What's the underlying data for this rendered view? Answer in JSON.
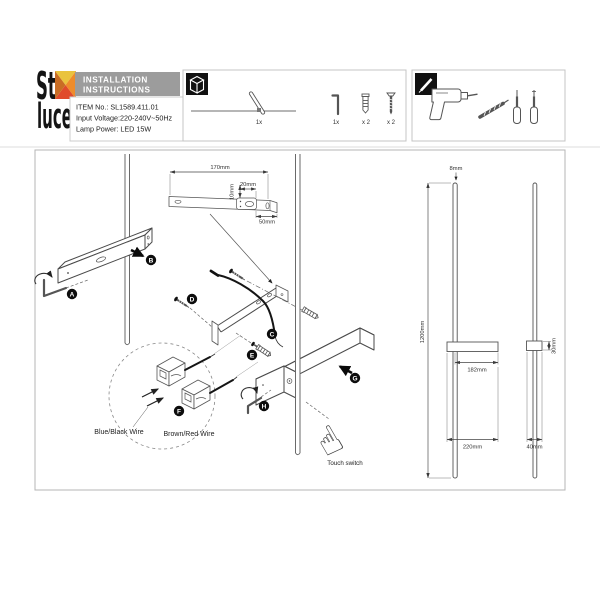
{
  "brand": {
    "word_top": "St",
    "word_bottom": "luce"
  },
  "logo_colors": {
    "top": "#eac33e",
    "right": "#ee8c2b",
    "bottom": "#e04b2b",
    "left": "#c96d24"
  },
  "header": {
    "line1": "INSTALLATION",
    "line2": "INSTRUCTIONS",
    "bg_color": "#9c9c9c"
  },
  "product": {
    "item_no": "ITEM No.: SL1589.411.01",
    "input_voltage": "Input Voltage:220-240V~50Hz",
    "lamp_power": "Lamp Power: LED 15W"
  },
  "parts": {
    "fixture_qty": "1x",
    "allen_key_qty": "1x",
    "anchor_qty": "x 2",
    "screw_qty": "x 2"
  },
  "steps": {
    "a": "A",
    "b": "B",
    "c": "C",
    "d": "D",
    "e": "E",
    "f": "F",
    "g": "G",
    "h": "H"
  },
  "plate_dims": {
    "length": "170mm",
    "hole": "20mm",
    "height": "10mm",
    "offset": "50mm"
  },
  "lamp_dims": {
    "rod_diameter": "8mm",
    "height": "1200mm",
    "arm_reach": "182mm",
    "arm_length": "220mm",
    "arm_side": "30mm",
    "base": "40mm"
  },
  "wiring": {
    "blue": "Blue/Black Wire",
    "brown": "Brown/Red Wire"
  },
  "switch_label": "Touch switch"
}
